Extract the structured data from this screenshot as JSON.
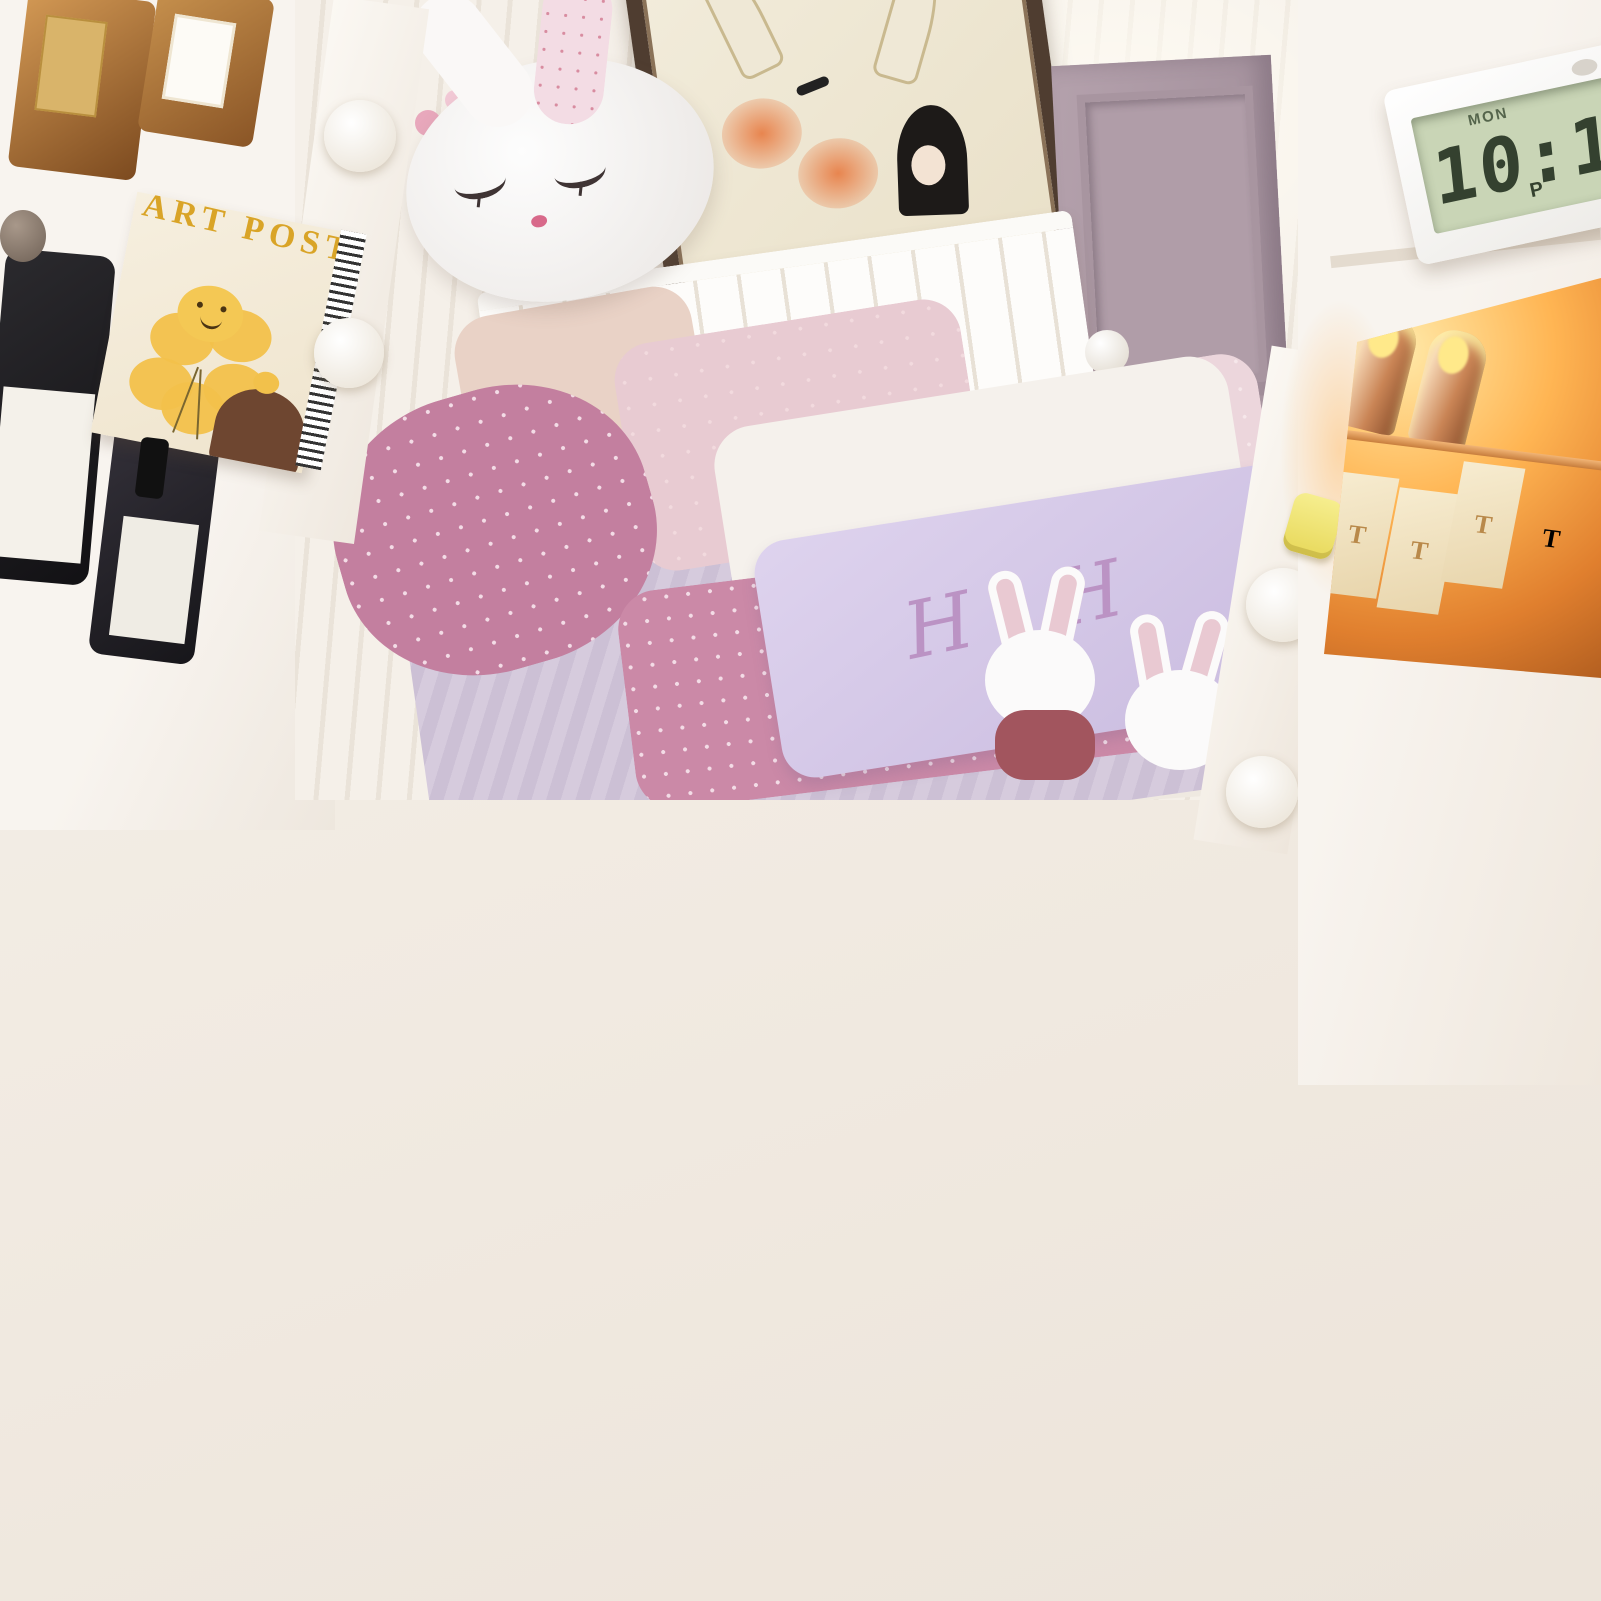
{
  "overlay": {
    "badge_label": "Embedded Tempered Glass Tabletop",
    "description_lines": [
      "Avisible glass top enabling you to locate your",
      "cosmetics at a glance,beautiful,look expensive",
      "anti-scalding and easy to clean"
    ]
  },
  "clock": {
    "day": "MON",
    "time": "10:10",
    "meridiem": "P"
  },
  "poster": {
    "title": "ART POSTER"
  },
  "mirror": {
    "pillow_monogram": "H H",
    "decor_number": "5",
    "decor_letters": "24 ZX"
  },
  "makeup_cabinet": {
    "lipstick_initial": "T"
  },
  "vanity_top": {
    "lipstick_box_label": "ST"
  },
  "skincare_cabinet": {
    "bottle_label_line1": "CLEANSING",
    "bottle_label_line2": "NECTAR",
    "jar_label": "FACIAL SCRUB",
    "tilted_jar_label": "FOOT BUTTER"
  },
  "charging_station": {
    "charge_text": "99% Charged"
  },
  "colors": {
    "badge_bg": "#6b4a3a",
    "badge_text": "#ffffff",
    "body_text": "#171514",
    "knob_yellow": "#f1e678",
    "glow_orange": "#ffa94d",
    "lcd_green": "#c9d5b6",
    "charge_ring_green": "#35e062",
    "wood_brown": "#a9601f",
    "drawer_wood": "#8a5a3e"
  }
}
